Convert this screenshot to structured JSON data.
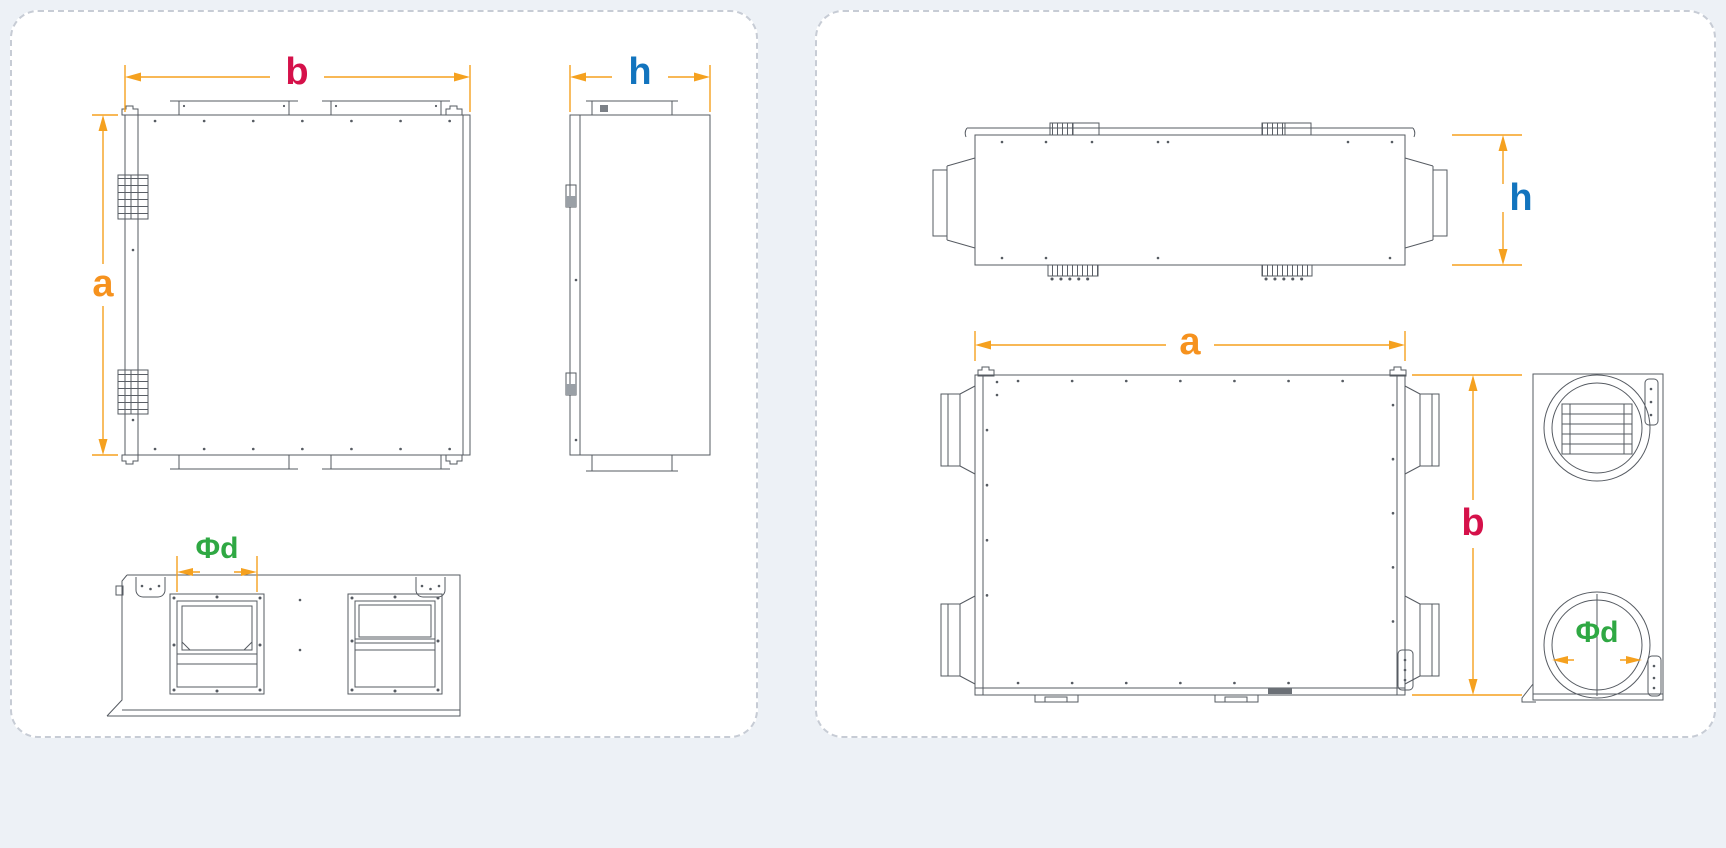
{
  "page": {
    "background": "#edf1f6",
    "panel_background": "#ffffff",
    "panel_border_color": "#c7ccd5"
  },
  "colors": {
    "dimension_lines": "#f5a11f",
    "label_a": "#f6921e",
    "label_b": "#d5114a",
    "label_h": "#1274be",
    "label_diameter": "#2fa843",
    "line_art": "#565b62"
  },
  "left_panel": {
    "dims": {
      "width": "b",
      "height": "a",
      "depth": "h",
      "duct_diameter": "Φd"
    }
  },
  "right_panel": {
    "dims": {
      "length": "a",
      "width": "b",
      "height": "h",
      "duct_diameter": "Φd"
    }
  }
}
